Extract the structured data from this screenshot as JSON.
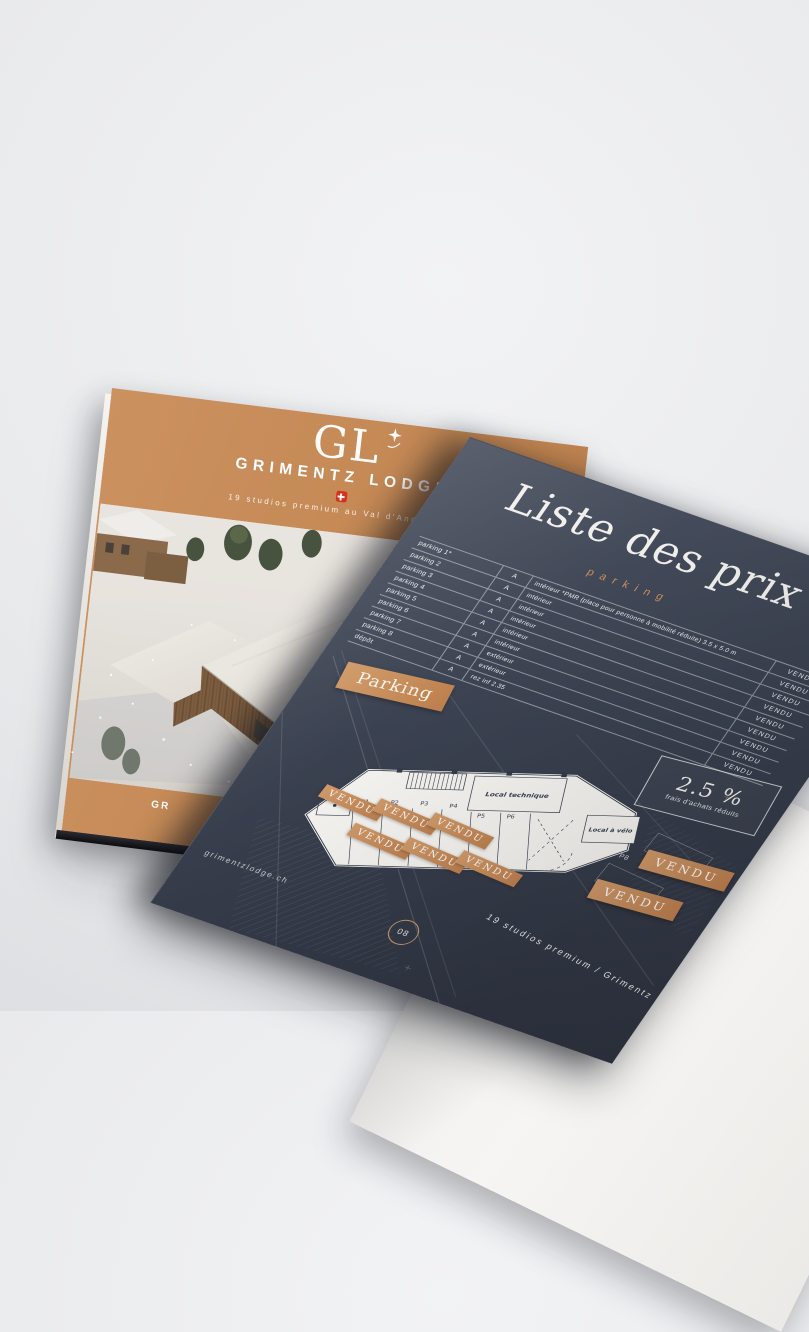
{
  "colors": {
    "accent_orange": "#c68a58",
    "page_navy": "#3a4150",
    "swiss_red": "#d7301c",
    "plan_paper": "#f4f3ef",
    "background": "#e9eaec"
  },
  "icons": {
    "logo_star": "four-point-star",
    "swiss_cross": "swiss-flag-cross",
    "page_number_ring": "circle-outline"
  },
  "cover": {
    "logo_text": "GL",
    "brand": "GRIMENTZ LODGE",
    "tagline": "19 studios premium au Val d'Anniviers",
    "footer_fragment": "GR"
  },
  "price_page": {
    "title": "Liste des prix",
    "subtitle": "parking",
    "table": {
      "rows": [
        {
          "name": "parking 1*",
          "building": "A",
          "location": "intérieur *PMR (place pour personne à mobilité réduite) 3.5 x 5.0 m",
          "status": "VENDU"
        },
        {
          "name": "parking 2",
          "building": "A",
          "location": "intérieur",
          "status": "VENDU"
        },
        {
          "name": "parking 3",
          "building": "A",
          "location": "intérieur",
          "status": "VENDU"
        },
        {
          "name": "parking 4",
          "building": "A",
          "location": "intérieur",
          "status": "VENDU"
        },
        {
          "name": "parking 5",
          "building": "A",
          "location": "intérieur",
          "status": "VENDU"
        },
        {
          "name": "parking 6",
          "building": "A",
          "location": "intérieur",
          "status": "VENDU"
        },
        {
          "name": "parking 7",
          "building": "A",
          "location": "extérieur",
          "status": "VENDU"
        },
        {
          "name": "parking 8",
          "building": "A",
          "location": "extérieur",
          "status": "VENDU"
        },
        {
          "name": "dépôt",
          "building": "A",
          "location": "rez inf 2.35",
          "status": "VENDU"
        }
      ]
    },
    "section_badge": "Parking",
    "promo": {
      "value": "2.5 %",
      "label": "frais d'achats réduits"
    },
    "plan": {
      "spot_labels": [
        "P1",
        "P2",
        "P3",
        "P4",
        "P5",
        "P6"
      ],
      "outdoor_spot_label": "P8",
      "room_labels": [
        "Local technique",
        "Local à vélo"
      ],
      "sold_stamps": [
        "VENDU",
        "VENDU",
        "VENDU",
        "VENDU",
        "VENDU",
        "VENDU"
      ],
      "outdoor_sold_badges": [
        "VENDU",
        "VENDU"
      ]
    },
    "page_number": "08",
    "footer": "19 studios premium / Grimentz",
    "website": "grimentzlodge.ch"
  }
}
